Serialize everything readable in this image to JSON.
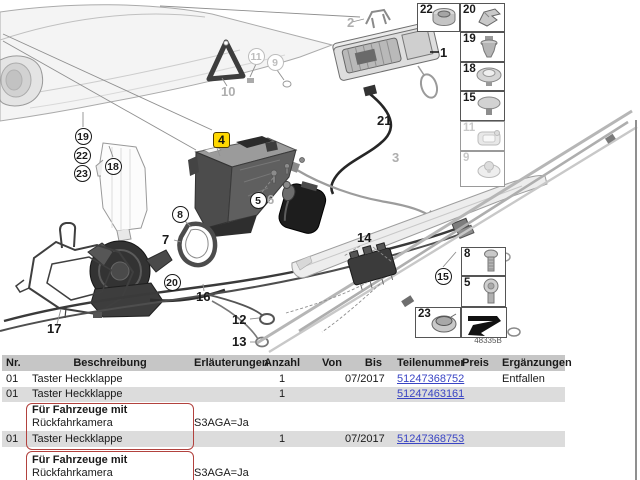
{
  "diagram": {
    "callouts": {
      "n1": "1",
      "n2": "2",
      "n3": "3",
      "n4": "4",
      "n5": "5",
      "n6": "6",
      "n7": "7",
      "n8": "8",
      "n9": "9",
      "n10": "10",
      "n11": "11",
      "n12": "12",
      "n13": "13",
      "n14": "14",
      "n15": "15",
      "n16": "16",
      "n17": "17",
      "n18": "18",
      "n19": "19",
      "n20": "20",
      "n21": "21",
      "n22": "22",
      "n23": "23"
    },
    "highlighted_callout": "4",
    "highlight_color": "#ffd800",
    "diagram_id": "48335B"
  },
  "sidebar": {
    "boxes": [
      {
        "label": "22",
        "icon": "grommet-nut-icon"
      },
      {
        "label": "20",
        "icon": "clamp-clip-icon"
      },
      {
        "label": "19",
        "icon": "sensor-plug-icon"
      },
      {
        "label": "18",
        "icon": "dome-grommet-icon"
      },
      {
        "label": "15",
        "icon": "blind-plug-icon"
      },
      {
        "label": "11",
        "icon": "bracket-clip-icon",
        "dimmed": true
      },
      {
        "label": "9",
        "icon": "oval-grommet-icon",
        "dimmed": true
      },
      {
        "label": "8",
        "icon": "torx-screw-icon"
      },
      {
        "label": "5",
        "icon": "pan-head-screw-icon"
      },
      {
        "label": "23",
        "icon": "flange-nut-icon"
      },
      {
        "label": "",
        "icon": "direction-arrow-icon"
      }
    ]
  },
  "table": {
    "link_color": "#3a45c4",
    "row_shade_color": "#dcdcdc",
    "header_bg_color": "#c6c6c6",
    "highlight_border_color": "#b2423e",
    "headers": {
      "nr": "Nr.",
      "beschreibung": "Beschreibung",
      "erlaeuterungen": "Erläuterungen",
      "anzahl": "Anzahl",
      "von": "Von",
      "bis": "Bis",
      "teilenummer": "Teilenummer",
      "preis": "Preis",
      "ergaenzungen": "Ergänzungen"
    },
    "rows": [
      {
        "nr": "01",
        "beschreibung": "Taster Heckklappe",
        "erlaeuterungen": "",
        "anzahl": "1",
        "von": "",
        "bis": "07/2017",
        "teilenummer": "51247368752",
        "preis": "",
        "ergaenzungen": "Entfallen"
      },
      {
        "nr": "01",
        "beschreibung": "Taster Heckklappe",
        "erlaeuterungen": "",
        "anzahl": "1",
        "von": "",
        "bis": "",
        "teilenummer": "51247463161",
        "preis": "",
        "ergaenzungen": ""
      },
      {
        "nr": "",
        "desc_line1": "Für Fahrzeuge mit",
        "desc_line2": "Rückfahrkamera",
        "erlaeuterungen": "S3AGA=Ja",
        "anzahl": "",
        "von": "",
        "bis": "",
        "teilenummer": "",
        "preis": "",
        "ergaenzungen": ""
      },
      {
        "nr": "01",
        "beschreibung": "Taster Heckklappe",
        "erlaeuterungen": "",
        "anzahl": "1",
        "von": "",
        "bis": "07/2017",
        "teilenummer": "51247368753",
        "preis": "",
        "ergaenzungen": ""
      },
      {
        "nr": "",
        "desc_line1": "Für Fahrzeuge mit",
        "desc_line2": "Rückfahrkamera",
        "desc_line3": "und",
        "erlaeuterungen": "S3AGA=Ja",
        "anzahl": "",
        "von": "",
        "bis": "",
        "teilenummer": "",
        "preis": "",
        "ergaenzungen": ""
      }
    ]
  }
}
